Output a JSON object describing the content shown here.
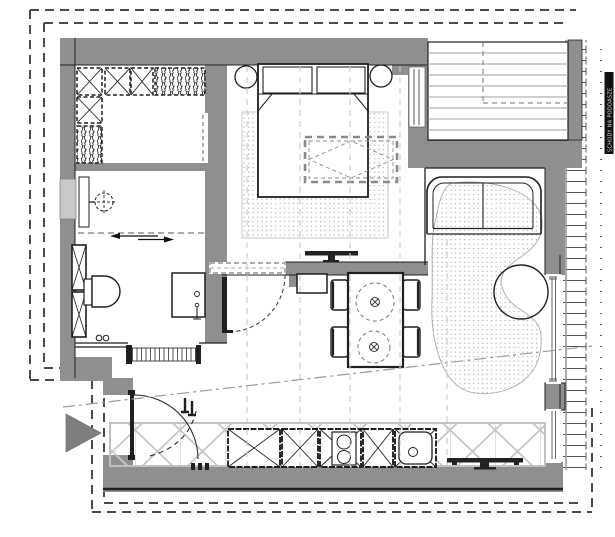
{
  "colors": {
    "background": "#ffffff",
    "wall": "#8f8f8f",
    "wall_dark": "#7e7e7e",
    "line": "#1f1f1f",
    "window_fill": "#c8c8c8",
    "hatch": "#555555",
    "boundary_dash": "#4a4a4a",
    "rug_dot": "#b0b0b0",
    "grid_dash": "#c8c8c8",
    "stair_tread": "#9e9e9e",
    "light_hatch": "#c7c7c7",
    "label_strip": "#111111",
    "label_text": "#dddddd"
  },
  "annotation": {
    "stair_label": "SCHODY NA PODDASZE"
  },
  "rooms": [
    {
      "id": "walk-in-closet",
      "label": "walk-in closet"
    },
    {
      "id": "bathroom",
      "label": "bathroom"
    },
    {
      "id": "bedroom",
      "label": "bedroom"
    },
    {
      "id": "stairwell",
      "label": "stairwell"
    },
    {
      "id": "living-area",
      "label": "living area"
    },
    {
      "id": "kitchen-dining",
      "label": "kitchen / dining"
    },
    {
      "id": "entry-hall",
      "label": "entry hall"
    }
  ],
  "symbols": [
    {
      "id": "site-boundary",
      "label": "dashed plot boundary"
    },
    {
      "id": "entrance-arrow",
      "label": "entrance direction triangle"
    },
    {
      "id": "roof-slope-line",
      "label": "dash-dot ceiling slope line"
    },
    {
      "id": "roof-grid-lines",
      "label": "faint dashed rafter grid lines"
    },
    {
      "id": "exterior-wall-hatch",
      "label": "masonry hatch on outside wall"
    },
    {
      "id": "skylight",
      "label": "dashed roof-window projection"
    },
    {
      "id": "low-ceiling-zone",
      "label": "light cross-hatched low headroom band"
    }
  ],
  "furniture": [
    {
      "id": "double-bed",
      "label": "double bed with two pillows"
    },
    {
      "id": "nightstand",
      "label": "round nightstand (x2)"
    },
    {
      "id": "bedroom-rug",
      "label": "dotted bedroom rug"
    },
    {
      "id": "bedroom-tv",
      "label": "TV on bedroom partition wall"
    },
    {
      "id": "wardrobe-cabinets",
      "label": "closet cabinets (X = shelves, hatch = hanging rail)"
    },
    {
      "id": "shower",
      "label": "ceiling shower head"
    },
    {
      "id": "toilet",
      "label": "wall hung toilet"
    },
    {
      "id": "washbasin",
      "label": "washbasin cabinet"
    },
    {
      "id": "bathroom-tall-cabinet",
      "label": "tall bathroom cabinet"
    },
    {
      "id": "bathroom-sliding-door",
      "label": "sliding partition with arrows"
    },
    {
      "id": "dining-table",
      "label": "dining table with four chairs"
    },
    {
      "id": "pendant-lamp",
      "label": "pendant lamp above table (x2)"
    },
    {
      "id": "sofa",
      "label": "two seat sofa"
    },
    {
      "id": "kidney-rug",
      "label": "kidney shaped living room rug"
    },
    {
      "id": "coffee-table",
      "label": "round coffee table"
    },
    {
      "id": "kitchen-run",
      "label": "kitchen base cabinets"
    },
    {
      "id": "cooktop",
      "label": "two burner cooktop"
    },
    {
      "id": "kitchen-sink",
      "label": "kitchen sink"
    },
    {
      "id": "living-tv",
      "label": "TV bench on bottom wall"
    },
    {
      "id": "entry-door",
      "label": "entrance door with swing arc"
    },
    {
      "id": "staircase",
      "label": "staircase treads with headroom dashed line"
    }
  ]
}
